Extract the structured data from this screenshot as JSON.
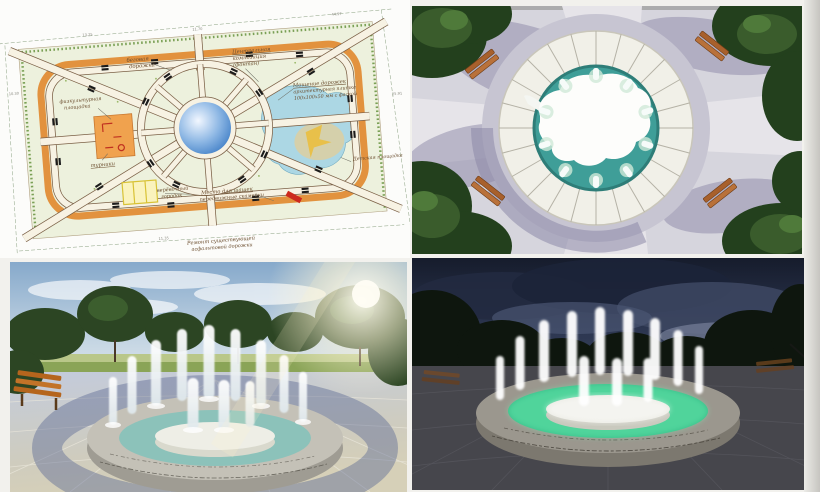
{
  "document": {
    "kind": "park-fountain-design-board",
    "background_color": "#f2f1ed",
    "page_edge_color": "#c6c5c0",
    "panels": [
      "site-plan",
      "aerial-render",
      "day-render",
      "night-render"
    ]
  },
  "plan": {
    "labels": {
      "track_l1": "беговая",
      "track_l2": "дорожка",
      "central_l1": "Центральная",
      "central_l2": "композиция",
      "central_l3": "(фонтан)",
      "sport_l1": "физкультурная",
      "sport_l2": "площадка",
      "equipment": "турники",
      "rope_l1": "верёвочный",
      "rope_l2": "городок",
      "paving_l1": "Мощение дорожек",
      "paving_l2": "архитектурная плитка",
      "paving_l3": "100x100x50 мм с фаской",
      "checkers_l1": "Место для шашек",
      "checkers_l2": "передвижные скамейки",
      "playground": "Детская площадка",
      "repair_l1": "Ремонт существующей",
      "repair_l2": "асфальтовой дорожки"
    },
    "dims": [
      "44.97",
      "25.91",
      "11.70",
      "13.25",
      "10.30",
      "11.35"
    ],
    "colors": {
      "sheet": "#fcfcfa",
      "lawn": "#edf1dd",
      "track": "#e2923e",
      "path_fill": "#f7f2e3",
      "path_edge": "#7a5f45",
      "fountain": "#5b93d8",
      "water_area": "#a9d6e5",
      "sport_area": "#f0a24e",
      "rope_park": "#f2de6a",
      "bench_symbol": "#1b1b1b",
      "red_marker": "#cc2a1e"
    }
  },
  "aerial": {
    "colors": {
      "pavement": "#d6d5dd",
      "path": "#e6e4e9",
      "shadow": "#8d89a8",
      "tree": "#23401d",
      "stone_ring": "#f1f0e8",
      "mortar": "#b5b2a6",
      "water": "#3f9e98",
      "island": "#ffffff",
      "bench": "#a8602c"
    }
  },
  "day": {
    "colors": {
      "sky_top": "#86a9cb",
      "sky_horizon": "#d9e3ea",
      "grass": "#8aa457",
      "tree": "#2c4523",
      "pavement_blue": "#c3cbdc",
      "pavement_tan": "#d6d0b8",
      "ring_shadow": "#5d6b95",
      "stone": "#c4c1b7",
      "water": "#8cc2ba",
      "island": "#eeeee6",
      "jet": "#ffffff",
      "bench": "#b5651d",
      "sun": "#fff6d8"
    }
  },
  "night": {
    "colors": {
      "sky_top": "#161c2c",
      "sky_mid": "#39445e",
      "cloud": "#7b849c",
      "tree": "#0e160e",
      "pavement": "#46464c",
      "stone": "#9b978e",
      "water": "#38bd88",
      "island": "#e9e9e1",
      "jet": "#ffffff"
    }
  }
}
